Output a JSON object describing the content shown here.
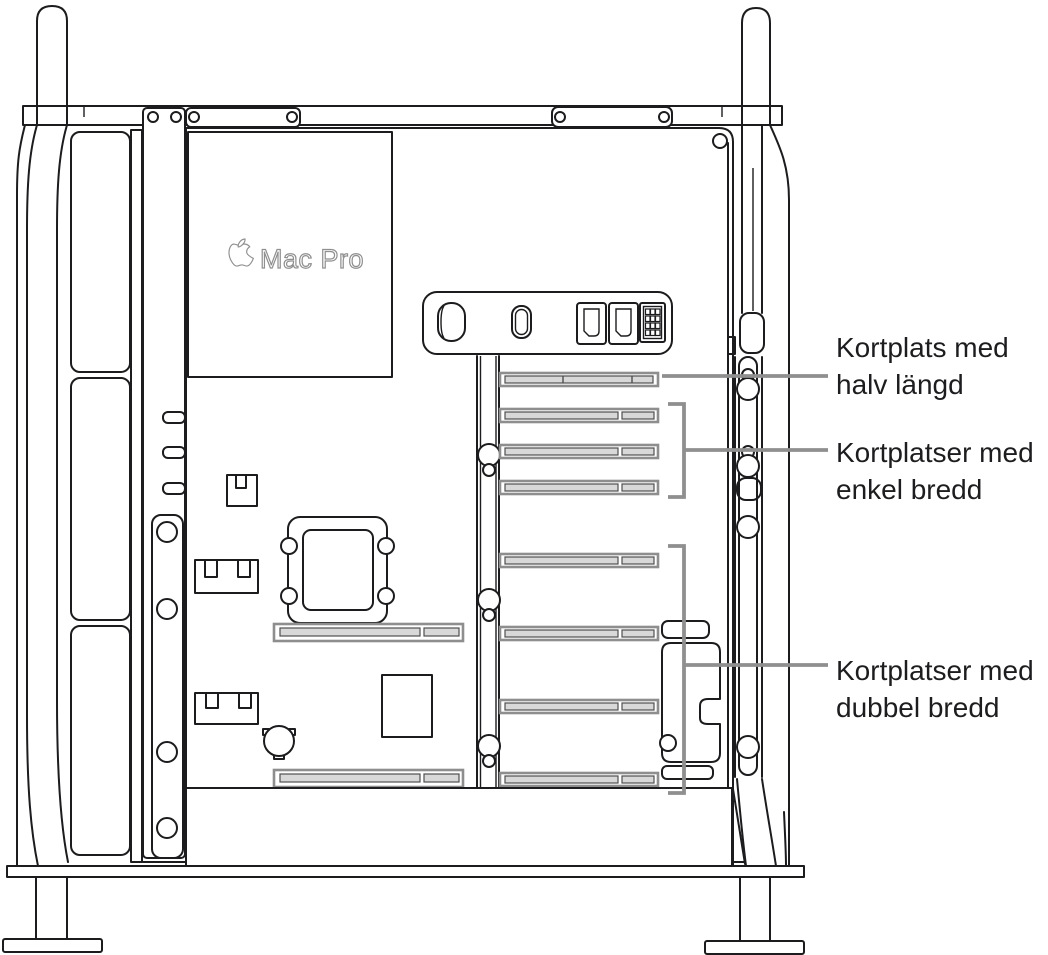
{
  "diagram": {
    "logo": {
      "icon": "apple-logo-icon",
      "text": "Mac Pro"
    },
    "callouts": [
      {
        "id": "half-length",
        "line1": "Kortplats med",
        "line2": "halv längd"
      },
      {
        "id": "single-wide",
        "line1": "Kortplatser med",
        "line2": "enkel bredd"
      },
      {
        "id": "double-wide",
        "line1": "Kortplatser med",
        "line2": "dubbel bredd"
      }
    ],
    "ports": [
      "power-button-icon",
      "usb-c-port-icon",
      "hdmi-port-icon",
      "hdmi-port-icon",
      "power-pins-icon"
    ],
    "slot_counts": {
      "half_length": 1,
      "single_wide": 3,
      "double_wide": 4
    },
    "colors": {
      "outline": "#1c1c1e",
      "callout_line": "#8f8f8f",
      "label_text": "#1d1d1f",
      "slot_border": "#8e8e8e",
      "slot_fill": "#d8d8d8",
      "logo_outline": "#8f8f8f",
      "background": "#ffffff"
    }
  }
}
